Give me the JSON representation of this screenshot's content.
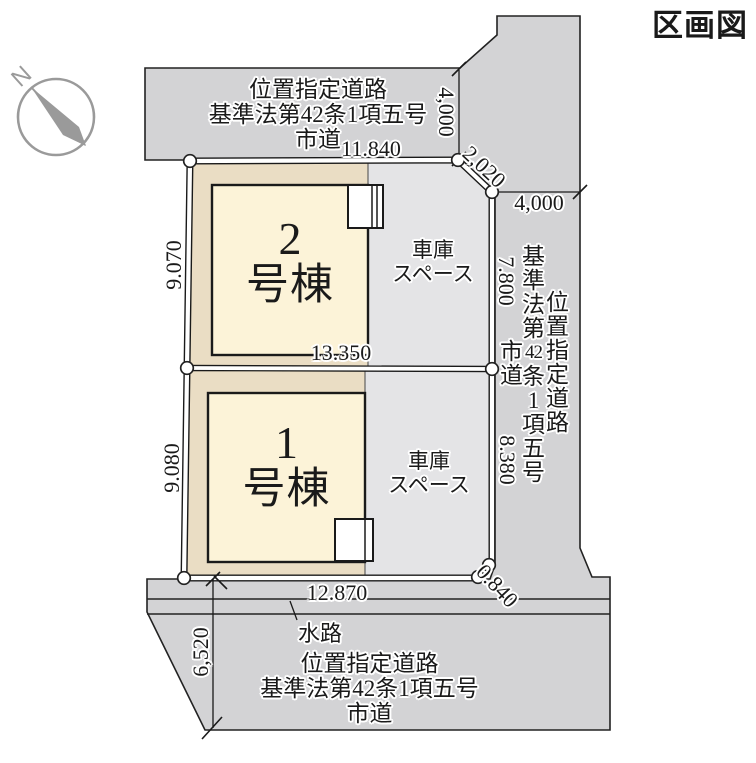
{
  "title": "区画図",
  "compass": {
    "north_label": "N"
  },
  "roads": {
    "top": {
      "lines": [
        "位置指定道路",
        "基準法第42条1項五号",
        "市道"
      ]
    },
    "bottom": {
      "lines": [
        "位置指定道路",
        "基準法第42条1項五号",
        "市道"
      ]
    },
    "right": {
      "col_right": [
        "位",
        "置",
        "指",
        "定",
        "道",
        "路"
      ],
      "col_middle": [
        "基",
        "準",
        "法",
        "第",
        "42",
        "条",
        "1",
        "項",
        "五",
        "号"
      ],
      "col_left": [
        "市",
        "道"
      ]
    },
    "waterway_label": "水路"
  },
  "buildings": {
    "unit2": {
      "number": "2",
      "suffix": "号棟"
    },
    "unit1": {
      "number": "1",
      "suffix": "号棟"
    },
    "garage": {
      "lines": [
        "車庫",
        "スペース"
      ]
    }
  },
  "dimensions": {
    "top_edge": "11.840",
    "top_road_width": "4,000",
    "chamfer_top": "2,020",
    "right_road_width": "4,000",
    "right_upper": "7.800",
    "right_lower": "8.380",
    "left_upper": "9.070",
    "left_lower": "9.080",
    "middle": "13.350",
    "bottom_edge": "12.870",
    "corner_cut": "0.840",
    "bottom_left": "6,520"
  },
  "colors": {
    "road": "#d3d3d5",
    "garage": "#e4e4e6",
    "parcel": "#eaddc4",
    "building": "#fcf3d8",
    "line": "#1a1a1a",
    "compass": "#9a9a9a"
  }
}
